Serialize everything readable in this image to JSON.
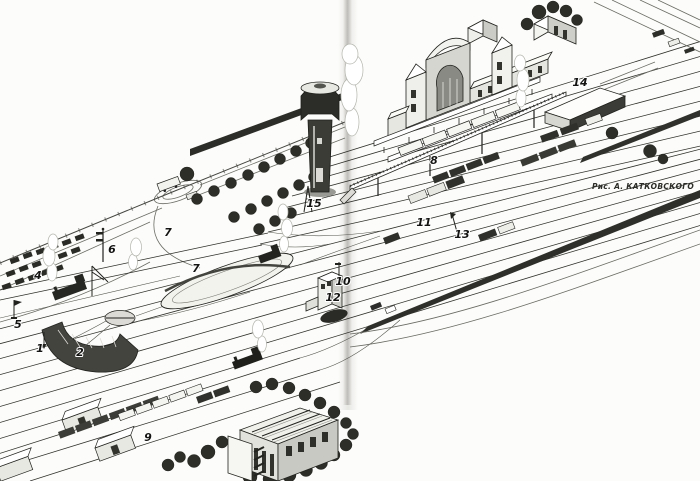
{
  "figure": {
    "kind": "scanned-book-illustration",
    "subject": "Bird's-eye drawing of a railway station and yard",
    "credit": "Рис. А. КАТКОВСКОГО",
    "callouts": [
      {
        "text": "1"
      },
      {
        "text": "2"
      },
      {
        "text": "4"
      },
      {
        "text": "5"
      },
      {
        "text": "6"
      },
      {
        "text": "7"
      },
      {
        "text": "7"
      },
      {
        "text": "8"
      },
      {
        "text": "9"
      },
      {
        "text": "10"
      },
      {
        "text": "11"
      },
      {
        "text": "12"
      },
      {
        "text": "13"
      },
      {
        "text": "14"
      },
      {
        "text": "15"
      }
    ],
    "palette": {
      "paper": "#fcfcfa",
      "ink": "#1f1f1c",
      "dark_fill": "#33332e",
      "light_fill": "#e9e9e4"
    }
  }
}
